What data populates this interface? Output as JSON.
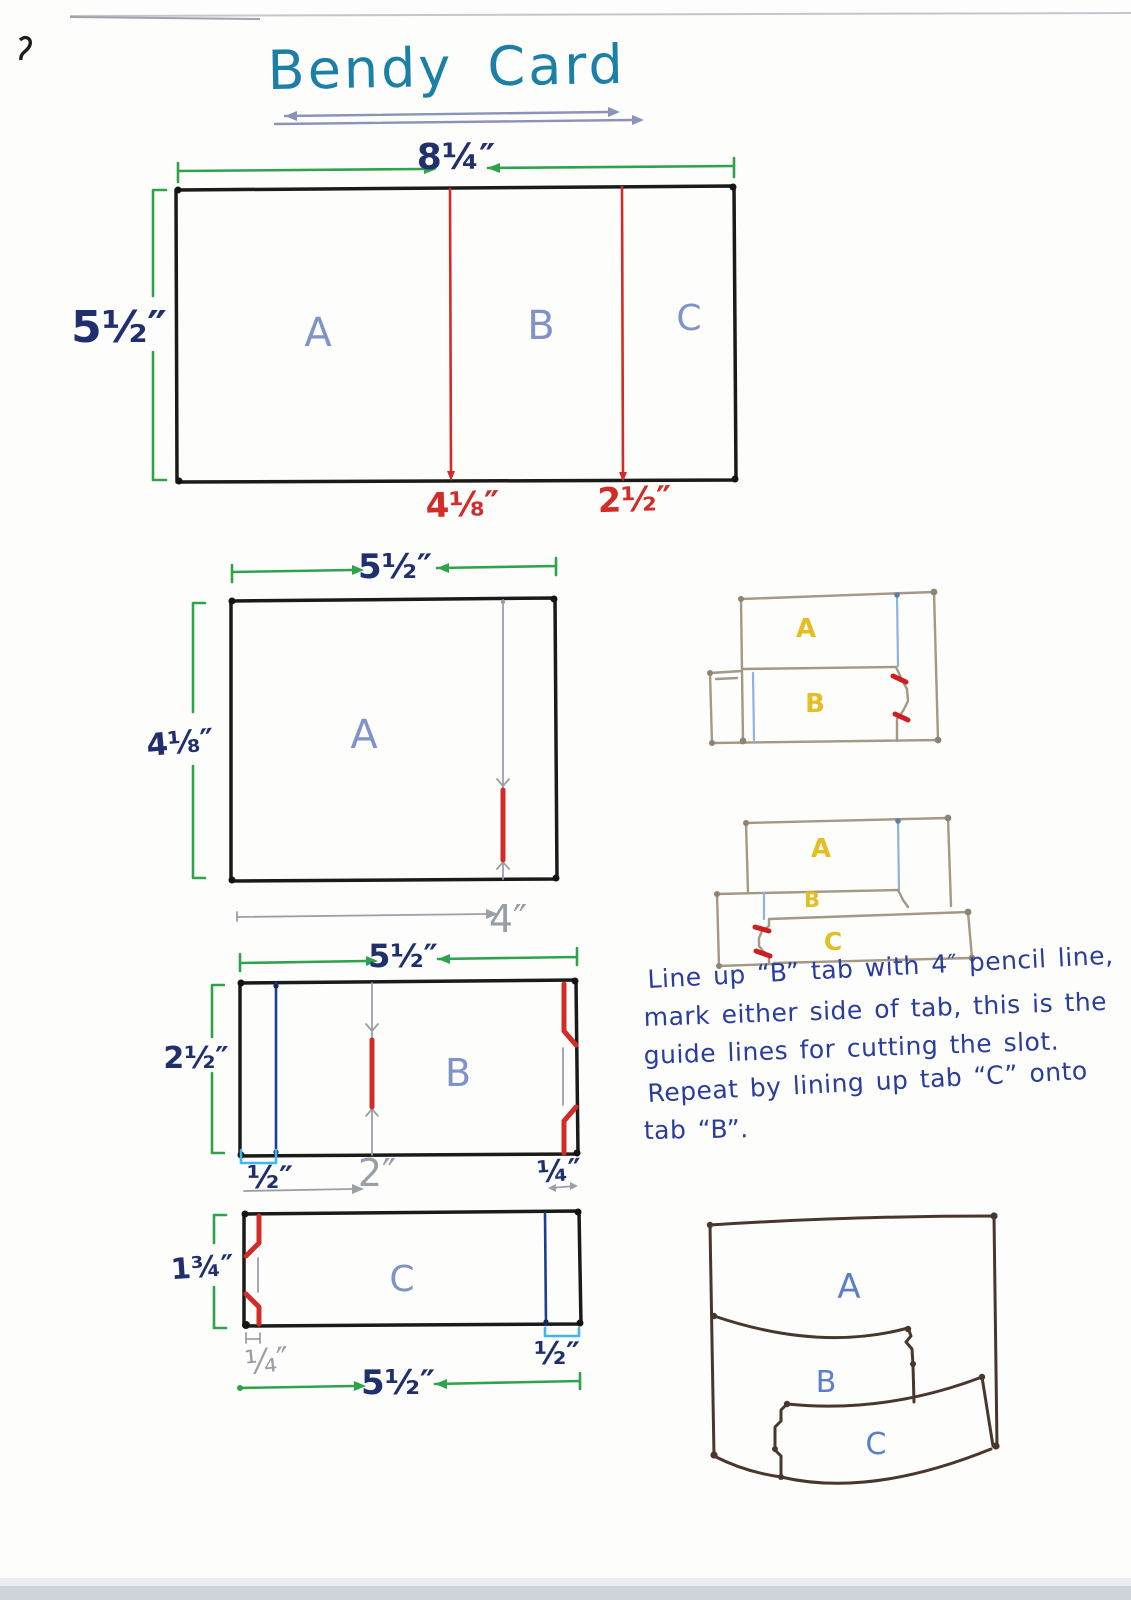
{
  "page": {
    "title": "Bendy Card"
  },
  "cut_plan": {
    "width_label": "8¼″",
    "height_label": "5½″",
    "panels": [
      "A",
      "B",
      "C"
    ],
    "cut_marks": [
      "4⅛″",
      "2½″"
    ]
  },
  "panel_a": {
    "width_label": "5½″",
    "height_label": "4⅛″",
    "label": "A",
    "pencil_mark": "4″"
  },
  "panel_b": {
    "width_label": "5½″",
    "height_label": "2½″",
    "label": "B",
    "fold_label": "½″",
    "pencil_mark": "2″",
    "tab_label": "¼″"
  },
  "panel_c": {
    "height_label": "1¾″",
    "label": "C",
    "tab_label": "¼″",
    "fold_label": "½″",
    "width_label": "5½″"
  },
  "assembly_ab": {
    "a": "A",
    "b": "B"
  },
  "assembly_abc": {
    "a": "A",
    "b": "B",
    "c": "C"
  },
  "note": {
    "lines": [
      "Line up “B” tab with 4″ pencil line,",
      "mark either side of tab, this is the",
      "guide lines for cutting the slot.",
      "Repeat by lining up tab “C” onto",
      "tab “B”."
    ]
  },
  "finished_card": {
    "a": "A",
    "b": "B",
    "c": "C"
  },
  "colors": {
    "title_teal": "#1c80a6",
    "measure_navy": "#20306f",
    "dimension_green": "#2fa34c",
    "cut_red": "#d22c28",
    "panel_label_blue": "#8093c6",
    "pencil_gray": "#989ea6",
    "fold_cyan": "#41b6e8",
    "fold_blue": "#1e3d8f",
    "sketch_tan": "#a49886",
    "sketch_yellow": "#e3bf25",
    "ink_blue": "#2a3d9c",
    "sketch_brown": "#49362c"
  }
}
